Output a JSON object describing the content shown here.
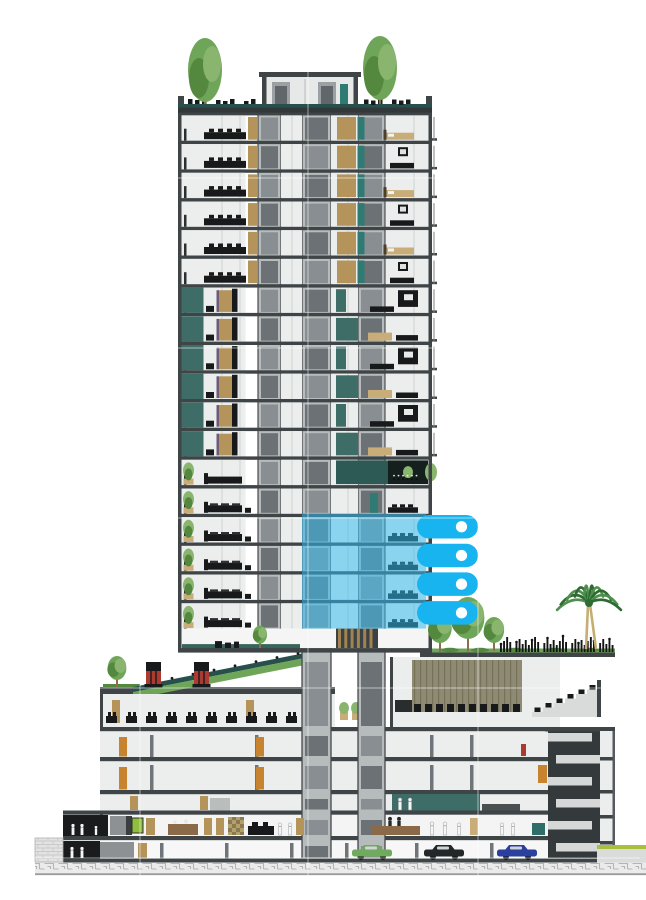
{
  "title": "Sectional rendering of a high-rise residential tower on a mixed-use podium with four highlighted floors",
  "canvas": {
    "width": 646,
    "height": 900,
    "background": "#ffffff"
  },
  "palette": {
    "slab": "#3f4447",
    "frame": "#545a5e",
    "wall": "#eceeed",
    "wallShade": "#d9dcdb",
    "coreLight": "#b6bbbc",
    "coreCabA": "#6b7174",
    "coreCabB": "#888e91",
    "coreEdge": "#45494c",
    "teal": "#3e6d68",
    "tealDark": "#27504c",
    "tealDoor": "#2f7a72",
    "tealGround": "#37655b",
    "tan": "#b5945c",
    "tanLight": "#c9ad78",
    "wood": "#a08350",
    "brown": "#8a6a48",
    "orange": "#c8832f",
    "black": "#17191a",
    "darkFig": "#26292c",
    "whiteFig": "#f4f5f4",
    "cyan": "#18b4ef",
    "cyanOverlay": "#2fbcf2",
    "green1": "#6fa558",
    "green2": "#8ab56f",
    "green3": "#55883f",
    "trunk": "#8a6f4a",
    "palmGreen": "#4e8f4e",
    "palmDark": "#2e6b33",
    "palmTrunk": "#c4ae72",
    "khaki": "#8f8a73",
    "khakiLine": "#767258",
    "red": "#ab3a31",
    "lime": "#a9bf3e",
    "limeBox": "#8fbe3f",
    "stairDark": "#34393b",
    "stairLight": "#d6d8d7",
    "groundBg": "#ebebeb",
    "groundLine": "#b5b5b5",
    "hatch": "#c9c9c9",
    "purple": "#6b5a78",
    "gridline": "#ffffff"
  },
  "tower": {
    "x": 178,
    "width": 254,
    "roofY": 112,
    "floorCount": 18,
    "floorPitch": 28.7,
    "wallThickness": 3.5,
    "zones": [
      {
        "name": "upper-apartments",
        "from": 0,
        "to": 5
      },
      {
        "name": "teal-facade-apartments",
        "from": 6,
        "to": 11
      },
      {
        "name": "amenity-transition",
        "from": 12,
        "to": 12
      },
      {
        "name": "planter-apartments",
        "from": 13,
        "to": 17
      }
    ],
    "coreBands": [
      [
        258,
        281
      ],
      [
        302,
        331
      ],
      [
        358,
        385
      ]
    ],
    "penthouse": {
      "x": 262,
      "width": 96,
      "y": 77,
      "height": 27,
      "roofY": 72
    },
    "roofBand": {
      "tealY": 104,
      "tealH": 3.5,
      "slabY": 107.5,
      "slabH": 5
    },
    "roofTrees": [
      {
        "cx": 205,
        "topY": 38
      },
      {
        "cx": 380,
        "topY": 36
      }
    ],
    "gardenLevel": {
      "y": 628.6,
      "height": 19.5,
      "treeCx": 260,
      "slatsX": 338,
      "slatsW": 38
    }
  },
  "highlight": {
    "overlay": {
      "x": 302,
      "width": 124
    },
    "firstFloor": 14,
    "lastFloor": 17,
    "tab": {
      "x": 417,
      "width": 61,
      "height": 23.5,
      "radius": 11.75,
      "dotCx": 461.5,
      "dotR": 5.6
    },
    "overlayOpacity": 0.52
  },
  "podium": {
    "left": 100,
    "right": 615,
    "roofTerraceRight": {
      "x": 420,
      "y": 652,
      "w": 195,
      "slabH": 5
    },
    "leftRoof": {
      "x": 100,
      "y": 687,
      "w": 235,
      "slabH": 7
    },
    "berm": {
      "x1": 133,
      "y1": 687,
      "x2": 320,
      "y2": 650,
      "thickness": 12
    },
    "chimneys": [
      {
        "x": 146
      },
      {
        "x": 194
      }
    ],
    "leftTree": {
      "cx": 117,
      "cy": 668
    },
    "restaurant": {
      "x": 103,
      "y": 694,
      "w": 232,
      "h": 33,
      "chairCount": 11
    },
    "terracePlanters": {
      "x": 340,
      "y": 703,
      "count": 3
    },
    "theater": {
      "x": 390,
      "y": 657,
      "w": 170,
      "h": 70,
      "panelX": 412,
      "panelW": 110,
      "seatRows": 10
    },
    "tiers": {
      "x": 532,
      "baseY": 717,
      "steps": 6,
      "stepW": 11,
      "rise": 4.5
    },
    "levels": [
      731,
      761,
      794,
      815,
      841
    ],
    "slabs": [
      727,
      757,
      790,
      810.5,
      836,
      858.5
    ],
    "orangeDoors": [
      119,
      256
    ],
    "stairTower": {
      "x": 548,
      "y": 731,
      "w": 52,
      "h": 127,
      "bandYs": [
        733,
        755,
        777,
        799,
        821,
        843
      ]
    },
    "rightWall": {
      "x": 600,
      "w": 15
    },
    "rightDeck": {
      "x": 597,
      "limeY": 845,
      "wallY": 849,
      "w": 49
    },
    "mezzanine": {
      "tealX": 392,
      "tealW": 88
    },
    "annex": {
      "x": 63,
      "roofY": 810.5,
      "blackRoomW": 45
    },
    "hatchBlock": {
      "x": 35,
      "y": 838,
      "w": 28,
      "h": 24
    }
  },
  "landscape": {
    "podiumTrees": [
      {
        "cx": 440,
        "cy": 628,
        "r": 15
      },
      {
        "cx": 468,
        "cy": 618,
        "r": 21
      },
      {
        "cx": 494,
        "cy": 630,
        "r": 13
      }
    ],
    "crowd": {
      "x1": 500,
      "x2": 614,
      "baseY": 652
    },
    "palm": {
      "cx": 589,
      "crownY": 601,
      "baseY": 649,
      "frondCount": 10,
      "frondLen": 33
    }
  },
  "groundFloor": {
    "y": 815,
    "h": 21,
    "desk": {
      "x": 372,
      "w": 48
    },
    "greenBox": {
      "x": 132,
      "w": 11
    },
    "checker": {
      "x": 228,
      "w": 16
    },
    "tealCabinet": {
      "x": 532,
      "w": 13
    }
  },
  "basement": {
    "y": 841,
    "h": 21,
    "cars": [
      {
        "name": "car-green",
        "x": 352,
        "color": "#6faa5e"
      },
      {
        "name": "car-black",
        "x": 424,
        "color": "#23272a"
      },
      {
        "name": "car-blue",
        "x": 497,
        "color": "#2b3f9e"
      }
    ],
    "columns": [
      160,
      225,
      290,
      345,
      415,
      490
    ]
  },
  "groundStrip": {
    "x": 35,
    "y": 862.5,
    "w": 611,
    "h": 12
  },
  "gridlines": {
    "vertical": [
      140,
      308,
      478
    ],
    "horizontal": [
      178,
      348,
      518,
      688,
      858
    ]
  }
}
